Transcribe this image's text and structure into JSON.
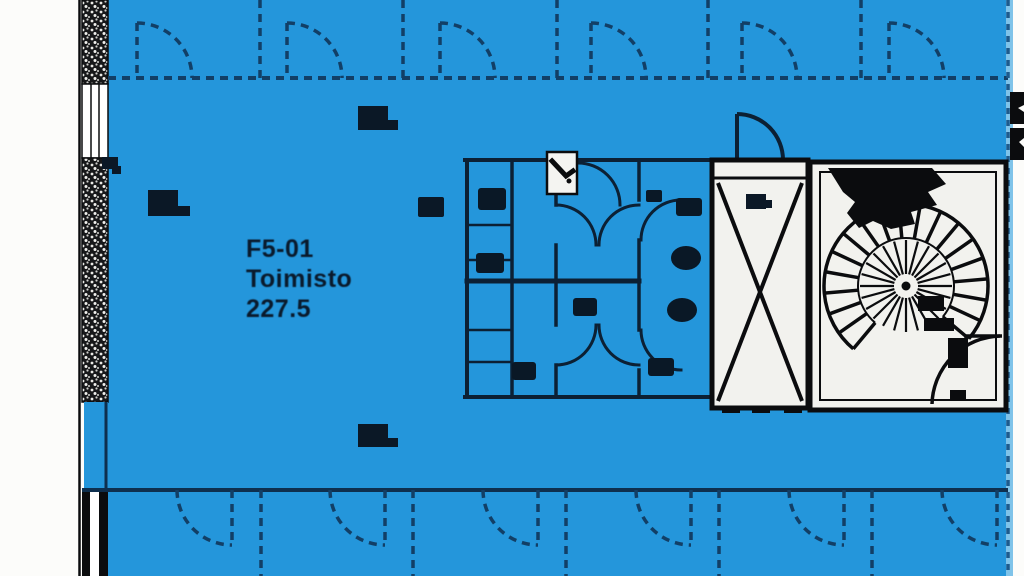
{
  "plan": {
    "main_room": {
      "id": "F5-01",
      "name": "Toimisto",
      "area": "227.5"
    },
    "colors": {
      "highlight_blue": "#2496DB",
      "line_navy": "#123F66",
      "wall_navy_dark": "#0C2034",
      "ink_black": "#0B0C0E",
      "room_white": "#F2F2EE",
      "page_white": "#FCFCFA",
      "boundary_strip_blue": "#7FC3E9",
      "label_text": "#0A1A2C"
    }
  }
}
